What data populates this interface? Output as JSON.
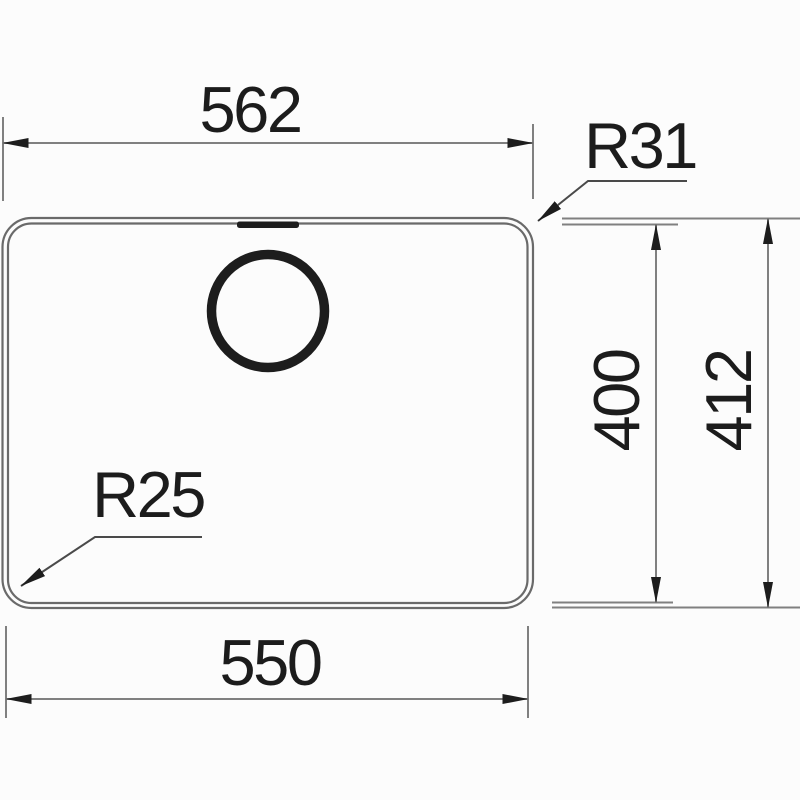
{
  "drawing": {
    "labels": {
      "outer_width": "562",
      "inner_width": "550",
      "inner_height": "400",
      "outer_height": "412",
      "radius_top_right": "R31",
      "radius_bottom_left": "R25"
    },
    "colors": {
      "background": "#fcfcfc",
      "outline": "#6a6a6a",
      "dim_line": "#808080",
      "leader": "#4a4a4a",
      "ink": "#1d1d1d",
      "text": "#1c1c1c"
    }
  }
}
